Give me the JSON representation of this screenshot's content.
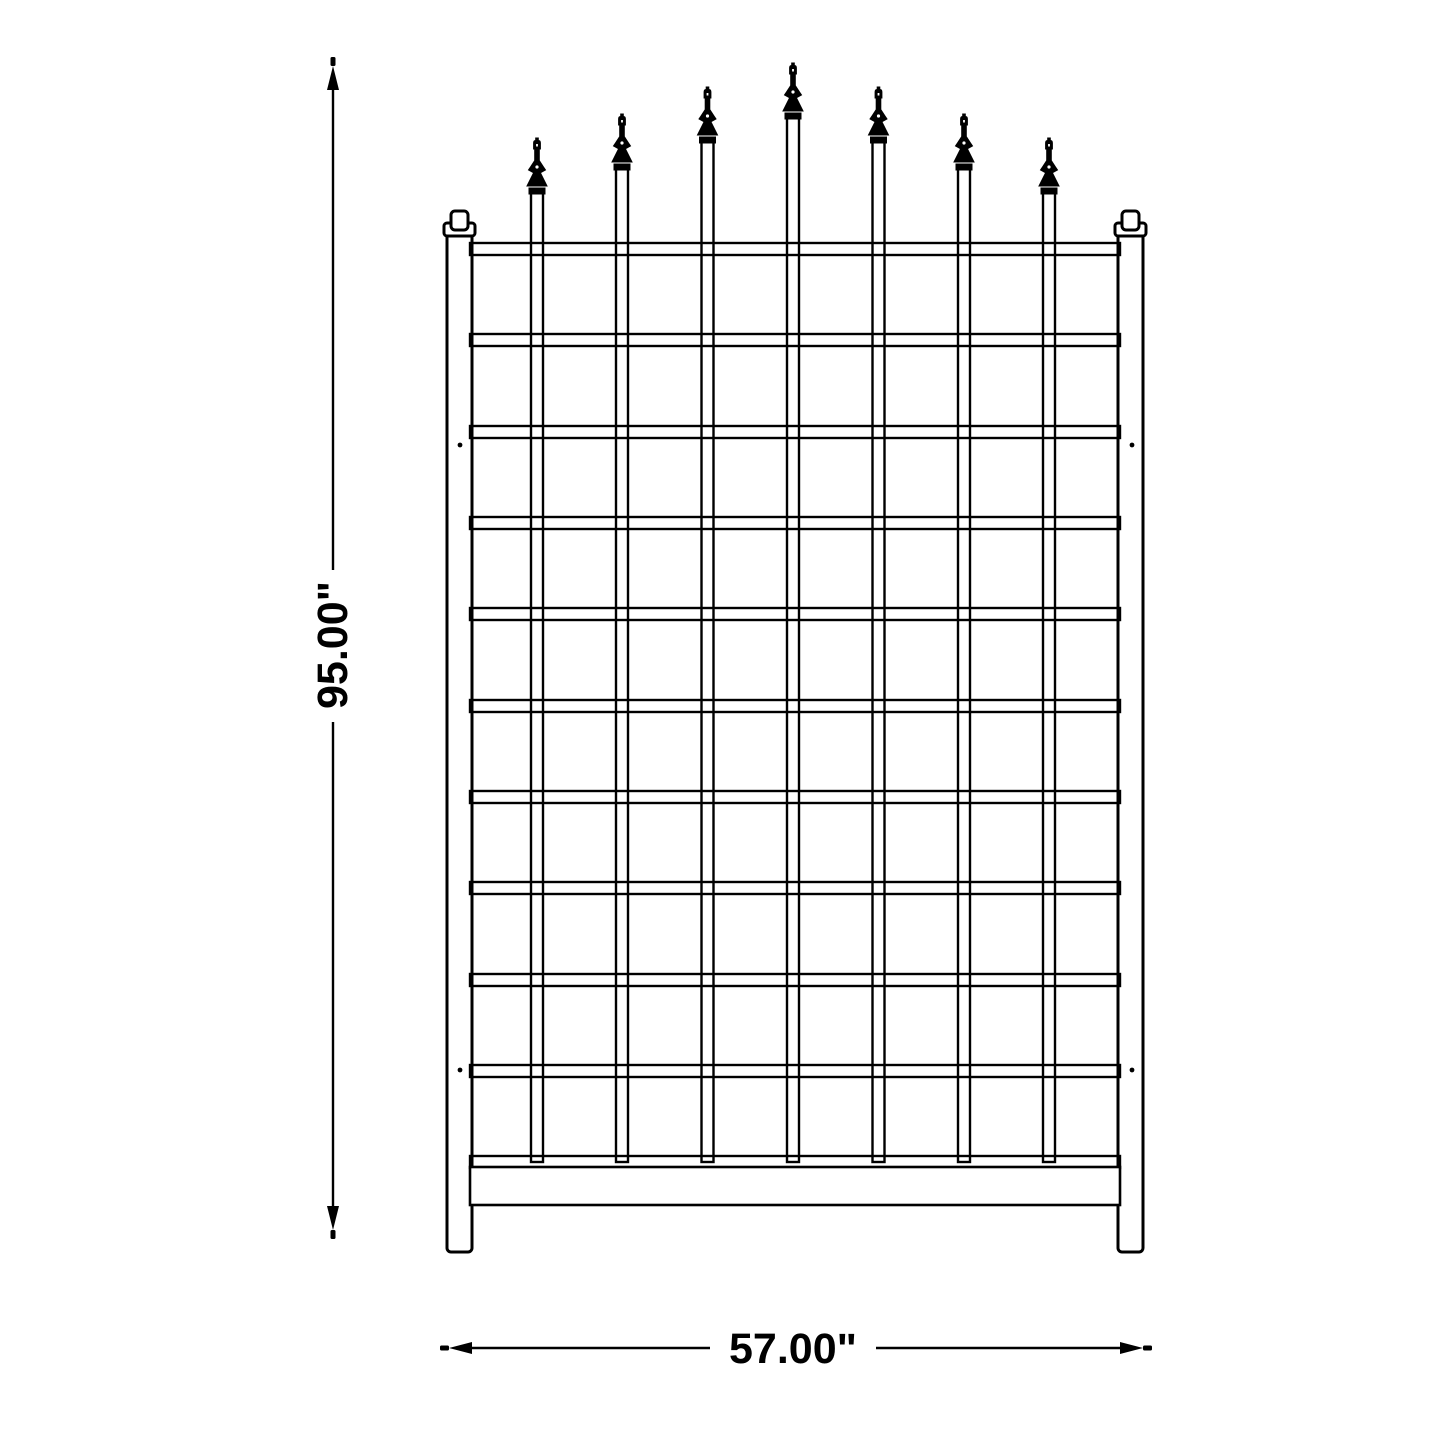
{
  "page": {
    "background": "#ffffff",
    "line_color": "#000000",
    "text_color": "#000000"
  },
  "dimensions": {
    "height_label": "95.00\"",
    "width_label": "57.00\""
  },
  "trellis": {
    "canvas_size": 1445,
    "posts": {
      "left_x": 447,
      "right_x": 1118,
      "width": 25,
      "top_y": 233,
      "bottom_y": 1252,
      "cap": {
        "collar_extend": 3,
        "collar_top": 223,
        "collar_h": 13,
        "block_w": 17,
        "block_top": 211,
        "block_h": 15
      }
    },
    "rails": {
      "x1": 470,
      "x2": 1120,
      "height": 12,
      "tops": [
        243,
        334,
        426,
        517,
        608,
        700,
        791,
        882,
        974,
        1065,
        1156
      ]
    },
    "bottom_board": {
      "top": 1167,
      "height": 38
    },
    "bars": {
      "width": 12,
      "centers": [
        537,
        622,
        707.5,
        793,
        878.5,
        964,
        1049
      ],
      "bottom_y": 1162,
      "tops": [
        193,
        169,
        142,
        118,
        142,
        169,
        193
      ]
    },
    "finial_tip_ys": [
      138,
      114,
      87,
      63,
      87,
      114,
      138
    ],
    "screw_holes": [
      [
        460,
        445
      ],
      [
        1132,
        445
      ],
      [
        460,
        1070
      ],
      [
        1132,
        1070
      ]
    ]
  }
}
